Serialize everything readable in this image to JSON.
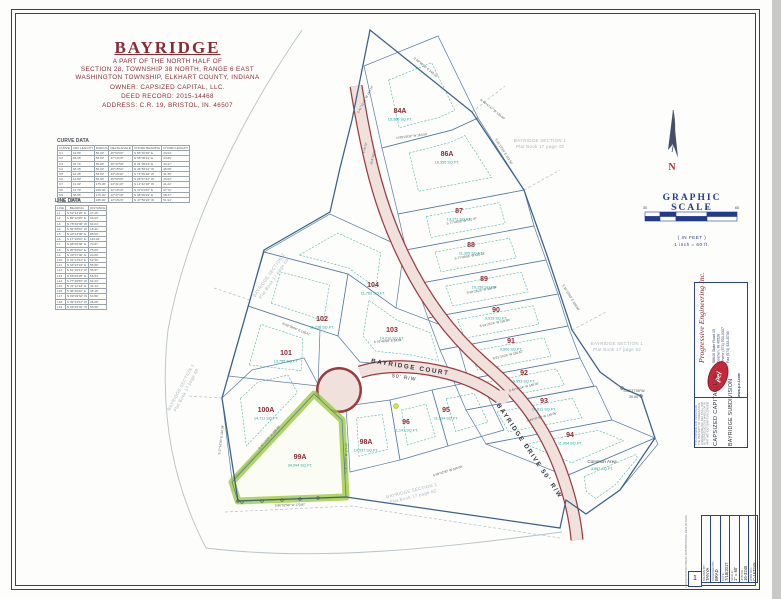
{
  "header": {
    "title": "BAYRIDGE",
    "subtitle_lines": [
      "A PART OF THE NORTH HALF OF",
      "SECTION 28, TOWNSHIP 38 NORTH, RANGE 6 EAST",
      "WASHINGTON TOWNSHIP, ELKHART COUNTY, INDIANA",
      "OWNER: CAPSIZED CAPITAL, LLC.",
      "DEED RECORD: 2015-14468",
      "ADDRESS: C.R. 19, BRISTOL, IN. 46507"
    ]
  },
  "curve_table": {
    "title": "CURVE DATA",
    "headers": [
      "CURVE",
      "ARC LENGTH",
      "RADIUS",
      "DELTA ANGLE",
      "CHORD BEARING",
      "CHORD LENGTH"
    ],
    "rows": [
      [
        "C1",
        "44.83'",
        "56.00'",
        "45°52'04\"",
        "S 65°16'36\" E",
        "43.64'"
      ],
      [
        "C2",
        "46.15'",
        "56.00'",
        "47°13'15\"",
        "N 68°06'21\" E",
        "44.86'"
      ],
      [
        "C3",
        "45.74'",
        "56.00'",
        "46°47'58\"",
        "N 21°05'44\" E",
        "44.47'"
      ],
      [
        "C4",
        "48.15'",
        "56.00'",
        "49°15'54\"",
        "N 26°56'12\" W",
        "45.68'"
      ],
      [
        "C5",
        "42.35'",
        "56.00'",
        "43°19'42\"",
        "S 73°09'38\" W",
        "41.35'"
      ],
      [
        "C6",
        "44.80'",
        "56.00'",
        "45°50'06\"",
        "S 28°37'44\" W",
        "43.62'"
      ],
      [
        "C7",
        "41.32'",
        "175.00'",
        "13°31'43\"",
        "S 12°42'18\" W",
        "41.22'"
      ],
      [
        "C8",
        "47.79'",
        "225.00'",
        "12°10'10\"",
        "N 11°01'32\" E",
        "47.70'"
      ],
      [
        "C9",
        "38.55'",
        "175.00'",
        "12°37'18\"",
        "S 48°09'29\" E",
        "38.47'"
      ],
      [
        "C10",
        "52.06'",
        "225.00'",
        "13°15'23\"",
        "N 47°50'26\" W",
        "51.94'"
      ]
    ]
  },
  "line_table": {
    "title": "LINE DATA",
    "headers": [
      "LINE",
      "BEARING",
      "DISTANCE"
    ],
    "rows": [
      [
        "L1",
        "N 52°43'20\" E",
        "37.26'"
      ],
      [
        "L2",
        "S 89°12'05\" E",
        "63.04'"
      ],
      [
        "L3",
        "N 78°46'00\" W",
        "64.04'"
      ],
      [
        "L4",
        "S 59°38'00\" W",
        "18.41'"
      ],
      [
        "L5",
        "N 40°13'00\" E",
        "88.60'"
      ],
      [
        "L6",
        "S 17°16'00\" E",
        "116.04'"
      ],
      [
        "L7",
        "N 86°02'00\" E",
        "70.87'"
      ],
      [
        "L8",
        "S 05°50'00\" E",
        "75.00'"
      ],
      [
        "L9",
        "N 49°37'00\" E",
        "20.00'"
      ],
      [
        "L10",
        "S 31°13'34\" E",
        "52.50'"
      ],
      [
        "L11",
        "N 64°23'24\" E",
        "55.80'"
      ],
      [
        "L12",
        "S 61°19'24\" W",
        "55.67'"
      ],
      [
        "L13",
        "N 68°26'25\" E",
        "56.84'"
      ],
      [
        "L14",
        "S 77°49'55\" W",
        "52.24'"
      ],
      [
        "L15",
        "N 41°12'13\" E",
        "44.14'"
      ],
      [
        "L16",
        "S 48°46'26\" E",
        "45.16'"
      ],
      [
        "L17",
        "N 89°29'32\" W",
        "63.50'"
      ],
      [
        "L18",
        "S 49°43'24\" W",
        "46.08'"
      ],
      [
        "L19",
        "N 09°29'32\" W",
        "63.50'"
      ]
    ]
  },
  "north_arrow": {
    "label": "N"
  },
  "scale_bar": {
    "title": "GRAPHIC SCALE",
    "ticks": [
      "30",
      "0",
      "30",
      "60"
    ],
    "in_feet": "( IN FEET )",
    "ratio": "1 inch = 60 ft."
  },
  "map": {
    "roads": [
      {
        "name": "BAYRIDGE COURT",
        "rw": "50' R/W"
      },
      {
        "name": "BAYRIDGE DRIVE 50' R/W",
        "rw": "50' R/W"
      }
    ],
    "lots": [
      {
        "num": "84A",
        "sqft": "15,366 SQ.FT.",
        "x": 400,
        "y": 113
      },
      {
        "num": "86A",
        "sqft": "16,355 SQ.FT.",
        "x": 447,
        "y": 156
      },
      {
        "num": "87",
        "sqft": "13,171 SQ.FT.",
        "x": 459,
        "y": 213
      },
      {
        "num": "88",
        "sqft": "11,305 SQ.FT.",
        "x": 471,
        "y": 247
      },
      {
        "num": "89",
        "sqft": "10,158 SQ.FT.",
        "x": 484,
        "y": 281
      },
      {
        "num": "90",
        "sqft": "9,919 SQ.FT.",
        "x": 496,
        "y": 312
      },
      {
        "num": "91",
        "sqft": "9,906 SQ.FT.",
        "x": 511,
        "y": 343
      },
      {
        "num": "92",
        "sqft": "9,993 SQ.FT.",
        "x": 524,
        "y": 375
      },
      {
        "num": "93",
        "sqft": "10,811 SQ.FT.",
        "x": 544,
        "y": 403
      },
      {
        "num": "94",
        "sqft": "11,954 SQ.FT.",
        "x": 570,
        "y": 437
      },
      {
        "num": "95",
        "sqft": "11,534 SQ.FT.",
        "x": 446,
        "y": 412
      },
      {
        "num": "96",
        "sqft": "11,141 SQ.FT.",
        "x": 406,
        "y": 424
      },
      {
        "num": "98A",
        "sqft": "14,937 SQ.FT.",
        "x": 366,
        "y": 444
      },
      {
        "num": "99A",
        "sqft": "34,094 SQ.FT.",
        "x": 300,
        "y": 459
      },
      {
        "num": "100A",
        "sqft": "14,711 SQ.FT.",
        "x": 266,
        "y": 412
      },
      {
        "num": "101",
        "sqft": "13,755 SQ.FT.",
        "x": 286,
        "y": 355
      },
      {
        "num": "102",
        "sqft": "11,738 SQ.FT.",
        "x": 322,
        "y": 321
      },
      {
        "num": "103",
        "sqft": "14,016 SQ.FT.",
        "x": 392,
        "y": 332
      },
      {
        "num": "104",
        "sqft": "11,762 SQ.FT.",
        "x": 373,
        "y": 287
      }
    ],
    "common_area": {
      "name": "Common Area",
      "sqft": "4,557 SQ.FT.",
      "x": 602,
      "y": 463
    },
    "jog_label": {
      "line1": "S49°37'00\"W",
      "line2": "20.00'",
      "x": 634,
      "y": 392
    },
    "adjacent_plats": [
      {
        "line1": "BAYRIDGE  SECTION 1",
        "line2": "Plat Book 17 page 43",
        "x": 540,
        "y": 142,
        "rot": 0
      },
      {
        "line1": "BAYRIDGE  SECTION 1",
        "line2": "Plat Book 17 page 62",
        "x": 617,
        "y": 345,
        "rot": 0
      },
      {
        "line1": "BAYRIDGE  SECTION 2",
        "line2": "Plat Book 17 page 60",
        "x": 270,
        "y": 276,
        "rot": -55
      },
      {
        "line1": "BAYRIDGE  SECTION 1",
        "line2": "Plat Book 17 page 48",
        "x": 182,
        "y": 388,
        "rot": -62
      },
      {
        "line1": "BAYRIDGE  SECTION 1",
        "line2": "Plat Book 17 page 62",
        "x": 412,
        "y": 492,
        "rot": -14
      }
    ],
    "bearings": [
      {
        "t": "S 41°12'13\" W  144.14'",
        "x": 366,
        "y": 100,
        "r": -62
      },
      {
        "t": "S 48°46'26\" E  145.16'",
        "x": 425,
        "y": 68,
        "r": 39
      },
      {
        "t": "S 31°13'34\" E  152.50'",
        "x": 503,
        "y": 152,
        "r": 57
      },
      {
        "t": "N 89°29'32\" W  163.50'",
        "x": 412,
        "y": 137,
        "r": -7
      },
      {
        "t": "L=9.73'",
        "x": 366,
        "y": 148,
        "r": -75
      },
      {
        "t": "Δ=4°18'28\"",
        "x": 374,
        "y": 157,
        "r": -75
      },
      {
        "t": "S 77°48'55\" W  151.97'",
        "x": 462,
        "y": 222,
        "r": -10
      },
      {
        "t": "S 77°49'55\" W  152.24'",
        "x": 470,
        "y": 257,
        "r": -10
      },
      {
        "t": "S 68°26'25\" W  156.84'",
        "x": 482,
        "y": 291,
        "r": -11
      },
      {
        "t": "S 64°23'24\" W  155.80'",
        "x": 495,
        "y": 324,
        "r": -12
      },
      {
        "t": "S 61°19'24\" W  155.67'",
        "x": 508,
        "y": 356,
        "r": -13
      },
      {
        "t": "S 49°43'24\" W  146.08'",
        "x": 524,
        "y": 388,
        "r": -14
      },
      {
        "t": "S 49°37'00\" W  140.06'",
        "x": 542,
        "y": 418,
        "r": -15
      },
      {
        "t": "S 78°46'00\" E  64.04'",
        "x": 388,
        "y": 342,
        "r": -4
      },
      {
        "t": "N 59°38'00\" E  118.41'",
        "x": 296,
        "y": 330,
        "r": 22
      },
      {
        "t": "S 17°16'00\" E  116.04'",
        "x": 222,
        "y": 440,
        "r": -83
      },
      {
        "t": "S 40°13'00\" W  208.60'",
        "x": 270,
        "y": 438,
        "r": -48
      },
      {
        "t": "N 05°50'00\" W  175.00'",
        "x": 347,
        "y": 458,
        "r": -88
      },
      {
        "t": "S 86°02'00\" W  170.87'",
        "x": 290,
        "y": 506,
        "r": -2
      },
      {
        "t": "S 59°42'00\" W  340.00'",
        "x": 448,
        "y": 472,
        "r": -17
      },
      {
        "t": "S 31°13'00\" E  158.00'",
        "x": 570,
        "y": 298,
        "r": 58
      },
      {
        "t": "N 48°47'47\" W  120.00'",
        "x": 492,
        "y": 110,
        "r": 39
      }
    ]
  },
  "sidebar": {
    "firm": {
      "name": "Progressive Engineering Inc.",
      "addr_lines": [
        "58640 State Road 15",
        "Goshen, IN 46528",
        "Phone (574) 533-0337",
        "Fax (574) 533-8736"
      ],
      "logo": "pei",
      "web": "www.p-e-i.com"
    },
    "cert_note": "THIS DRAWING AND DESIGN ARE THE PROPERTY OF PROGRESSIVE ENGINEERING INC. AND SHALL NOT BE REPRODUCED IN WHOLE OR IN PART WITHOUT WRITTEN CONSENT.",
    "client": "CAPSIZED CAPITAL, LLC",
    "project": "BAYRIDGE SUBDIVISION",
    "title_block": {
      "rows": [
        {
          "label": "DRAWN BY:",
          "value": "TANYA"
        },
        {
          "label": "CHECKED BY:",
          "value": "BRAD"
        },
        {
          "label": "DATE:",
          "value": "7/18/2017"
        },
        {
          "label": "SCALE:",
          "value": "1\" = 60'"
        },
        {
          "label": "JOB NO.:",
          "value": "16-3245"
        },
        {
          "label": "DWG NO.:",
          "value": "C-163245"
        }
      ],
      "sheet": "1",
      "file_path": "L:\\PEI16\\SURVEYING\\16-3245\\BAYRIDGE REPLAT.DWG"
    }
  }
}
